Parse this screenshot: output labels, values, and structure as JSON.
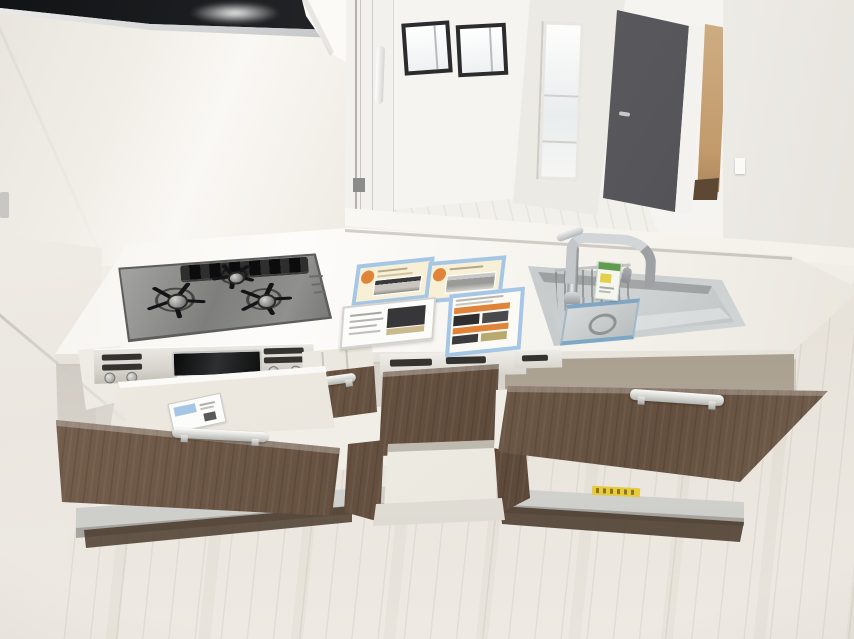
{
  "meta": {
    "type": "interior-photo",
    "subject": "system-kitchen-with-open-drawers",
    "visible_text": "none-legible",
    "width_px": 854,
    "height_px": 639
  },
  "palette": {
    "wall": "#f1eee8",
    "wallShade": "#e6e2da",
    "counter": "#f9f7f2",
    "counterEdge": "#dcd7ce",
    "hood": "#1b1c1e",
    "railSilver": "#c7c9c9",
    "roomWall": "#f6f4f0",
    "roomFloor": "#efede8",
    "windowFrame": "#2c2c2e",
    "doorGray": "#55555a",
    "doorwayTan": "#c29a6b",
    "wood": "#6d5847",
    "woodDark": "#4e3d30",
    "steel": "#b9bdbd",
    "steelDark": "#9aa0a0",
    "steelLight": "#dfe2e2",
    "interior": "#f3f0e9",
    "floor": "#eae6df",
    "accentBlue": "#a5c6e4",
    "accentOrange": "#df8438",
    "cream": "#f8f0d6",
    "labelYellow": "#e7ca3e",
    "tagGreen": "#5f9c50"
  },
  "scene": {
    "objects": [
      "range-hood",
      "upper-cabinet-corner",
      "pass-through-opening",
      "sliding-glass-door-edge",
      "living-room-window-1",
      "living-room-window-2",
      "living-room-tall-window",
      "living-room-door",
      "hallway-doorway",
      "light-switch",
      "counter-ledge",
      "countertop",
      "gas-cooktop",
      "cooktop-burner-left",
      "cooktop-burner-back",
      "cooktop-burner-right",
      "grill-exhaust-vent",
      "stove-control-panel",
      "grill-window",
      "promo-pamphlet-left",
      "promo-pamphlet-right",
      "info-card-stand",
      "promo-pamphlet-vertical",
      "kitchen-sink",
      "faucet",
      "faucet-product-tag",
      "sink-rack",
      "drain-tray",
      "built-in-unit-rail",
      "cutlery-drawer",
      "middle-cabinet-door",
      "floor-container-drawer",
      "left-deep-drawer",
      "right-deep-drawer",
      "drawer-card",
      "plinth-rail",
      "plinth-yellow-label",
      "wood-flooring",
      "left-wall",
      "glass-panel-edge"
    ],
    "burner_count": 3,
    "open_drawer_count": 5
  }
}
